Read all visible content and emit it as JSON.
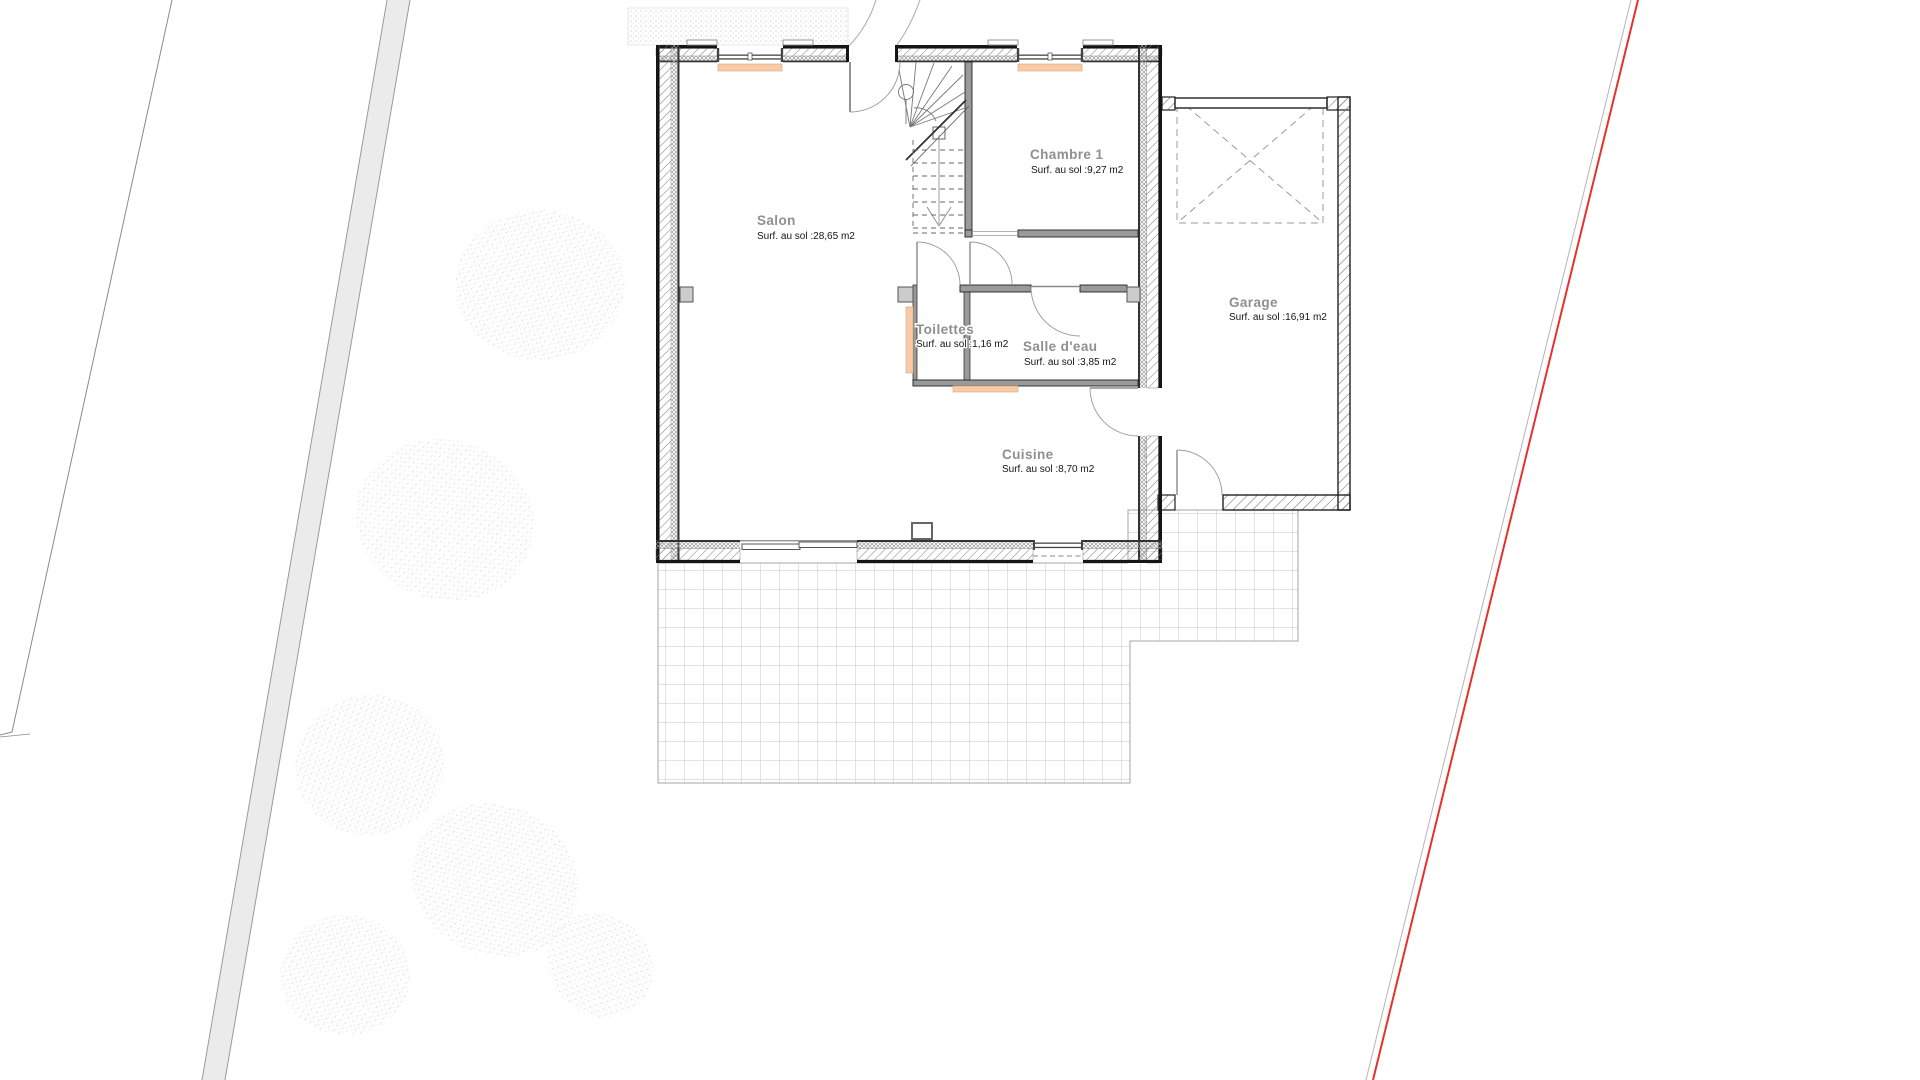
{
  "plan": {
    "type": "architectural-floor-plan",
    "rooms": [
      {
        "name": "Salon",
        "area": "Surf. au sol :28,65 m2"
      },
      {
        "name": "Chambre 1",
        "area": "Surf. au sol :9,27 m2"
      },
      {
        "name": "Toilettes",
        "area": "Surf. au sol :1,16 m2"
      },
      {
        "name": "Salle d'eau",
        "area": "Surf. au sol :3,85 m2"
      },
      {
        "name": "Cuisine",
        "area": "Surf. au sol :8,70 m2"
      },
      {
        "name": "Garage",
        "area": "Surf. au sol :16,91 m2"
      }
    ],
    "colors": {
      "radiator": "#f6cba6",
      "boundary_red": "#e8312a",
      "wall_dark": "#151515",
      "partition_gray": "#9a9a9a",
      "grid_gray": "#c5c5c5",
      "band_gray": "#ebebeb"
    }
  }
}
